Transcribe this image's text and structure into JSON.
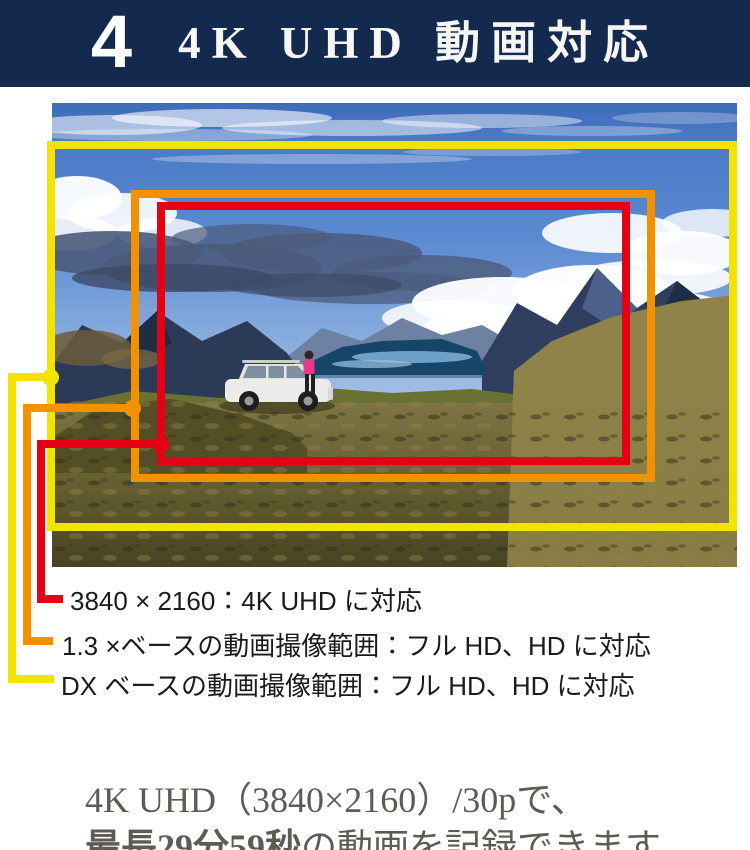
{
  "banner": {
    "number": "4",
    "title": "4K UHD 動画対応",
    "bg_color": "#14294e",
    "text_color": "#ffffff"
  },
  "figure": {
    "photo": "mountain-lake-landscape-with-suv-and-person",
    "frames": [
      {
        "id": "4k-uhd",
        "color": "#e60014"
      },
      {
        "id": "1.3x-base",
        "color": "#f29200"
      },
      {
        "id": "dx-base",
        "color": "#f3e400"
      }
    ]
  },
  "legend": {
    "items": [
      {
        "id": "4k-uhd",
        "color": "#e60014",
        "label": "3840 × 2160：4K UHD に対応"
      },
      {
        "id": "1.3x-base",
        "color": "#f29200",
        "label": "1.3 ×ベースの動画撮像範囲：フル HD、HD に対応"
      },
      {
        "id": "dx-base",
        "color": "#f3e400",
        "label": "DX ベースの動画撮像範囲：フル HD、HD に対応"
      }
    ]
  },
  "caption": {
    "line1": "4K UHD（3840×2160）/30pで、",
    "line2_bold": "最長29分59秒",
    "line2_rest": "の動画を記録できます。"
  },
  "colors": {
    "banner_bg": "#14294e",
    "frame_4k": "#e60014",
    "frame_1_3x": "#f29200",
    "frame_dx": "#f3e400",
    "legend_text": "#1b1b1b",
    "caption_text": "#5e5b55"
  }
}
